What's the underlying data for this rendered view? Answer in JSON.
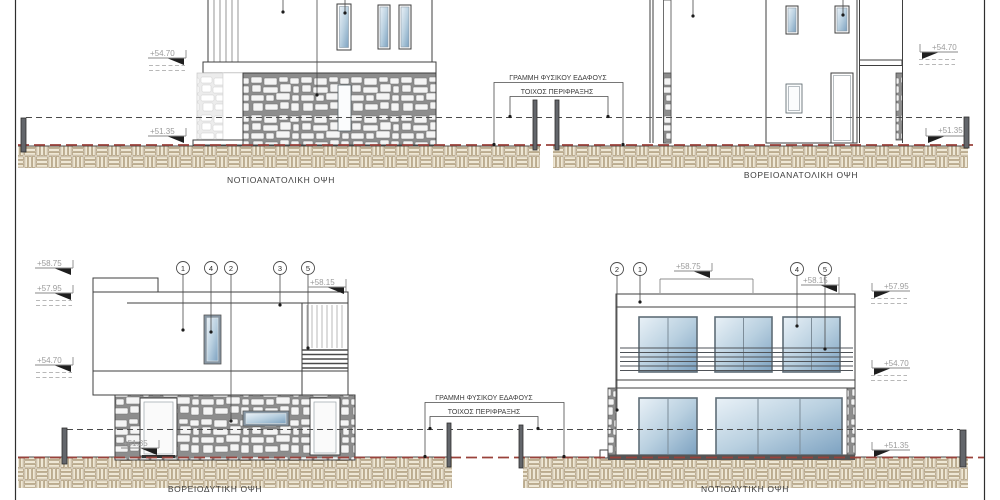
{
  "elevations": {
    "top_left": {
      "title": "ΝΟΤΙΟΑΝΑΤΟΛΙΚΗ ΟΨΗ",
      "levels": {
        "l1": "+54.70",
        "l2": "+51.35"
      }
    },
    "top_right": {
      "title": "ΒΟΡΕΙΟΑΝΑΤΟΛΙΚΗ ΟΨΗ",
      "levels": {
        "r1": "+54.70",
        "r2": "+51.35"
      }
    },
    "bottom_left": {
      "title": "ΒΟΡΕΙΟΔΥΤΙΚΗ ΟΨΗ",
      "levels": {
        "l1": "+58.75",
        "l2": "+57.95",
        "l3": "+54.70",
        "l4": "+51.35",
        "r1": "+58.15"
      },
      "keynotes": [
        "1",
        "4",
        "2",
        "3",
        "5"
      ]
    },
    "bottom_right": {
      "title": "ΝΟΤΙΟΔΥΤΙΚΗ ΟΨΗ",
      "levels": {
        "t1": "+58.75",
        "t2": "+58.15",
        "r1": "+57.95",
        "r2": "+54.70",
        "r3": "+51.35"
      },
      "keynotes": [
        "2",
        "1",
        "4",
        "5"
      ]
    }
  },
  "callouts": {
    "ground_line": "ΓΡΑΜΜΗ ΦΥΣΙΚΟΥ ΕΔΑΦΟΥΣ",
    "fence_wall": "ΤΟΙΧΟΣ ΠΕΡΙΦΡΑΞΗΣ"
  },
  "colors": {
    "ground_line_red": "#9a423b",
    "stone_joint_gray": "#8d8d8d",
    "earth_hatch_tan": "#a5916d",
    "glass_blue": "#7da2c1"
  }
}
